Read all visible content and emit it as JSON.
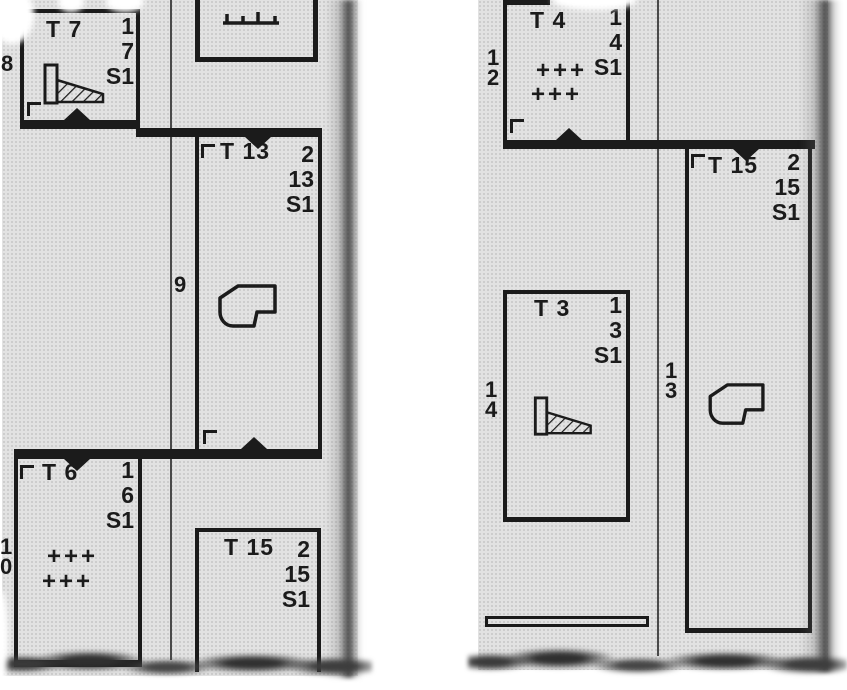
{
  "diagram": {
    "left_fragment": {
      "aisle_numbers": {
        "top": "8",
        "middle": "9",
        "bottom": "10"
      },
      "compartments": {
        "t7": {
          "title": "T 7",
          "stack": [
            "1",
            "7",
            "S1"
          ],
          "icon": "hatched-ramp"
        },
        "t13": {
          "title": "T 13",
          "stack": [
            "2",
            "13",
            "S1"
          ],
          "icon": "fixture-outline"
        },
        "t6": {
          "title": "T 6",
          "stack": [
            "1",
            "6",
            "S1"
          ],
          "plus_rows": [
            "+++",
            "+++"
          ]
        },
        "t15": {
          "title": "T 15",
          "stack": [
            "2",
            "15",
            "S1"
          ]
        }
      }
    },
    "right_fragment": {
      "aisle_numbers": {
        "top": "12",
        "left": "14",
        "middle": "13"
      },
      "compartments": {
        "t4": {
          "title": "T 4",
          "stack": [
            "1",
            "4",
            "S1"
          ],
          "plus_rows": [
            "+++",
            "+++"
          ]
        },
        "t15": {
          "title": "T 15",
          "stack": [
            "2",
            "15",
            "S1"
          ],
          "icon": "fixture-outline"
        },
        "t3": {
          "title": "T 3",
          "stack": [
            "1",
            "3",
            "S1"
          ],
          "icon": "hatched-ramp"
        }
      }
    },
    "icons": {
      "hatched_ramp": "ramp-with-diagonal-hatching",
      "fixture_outline": "fixture-blob-outline",
      "plus_markers": "plus-sign-grid",
      "door_marker": "triangle-door-marker",
      "comb": "partial-fixture-comb",
      "bench": "bench-bar"
    },
    "colors": {
      "paper": "#e2e2e2",
      "ink": "#1b1b1b",
      "background": "#ffffff"
    }
  }
}
